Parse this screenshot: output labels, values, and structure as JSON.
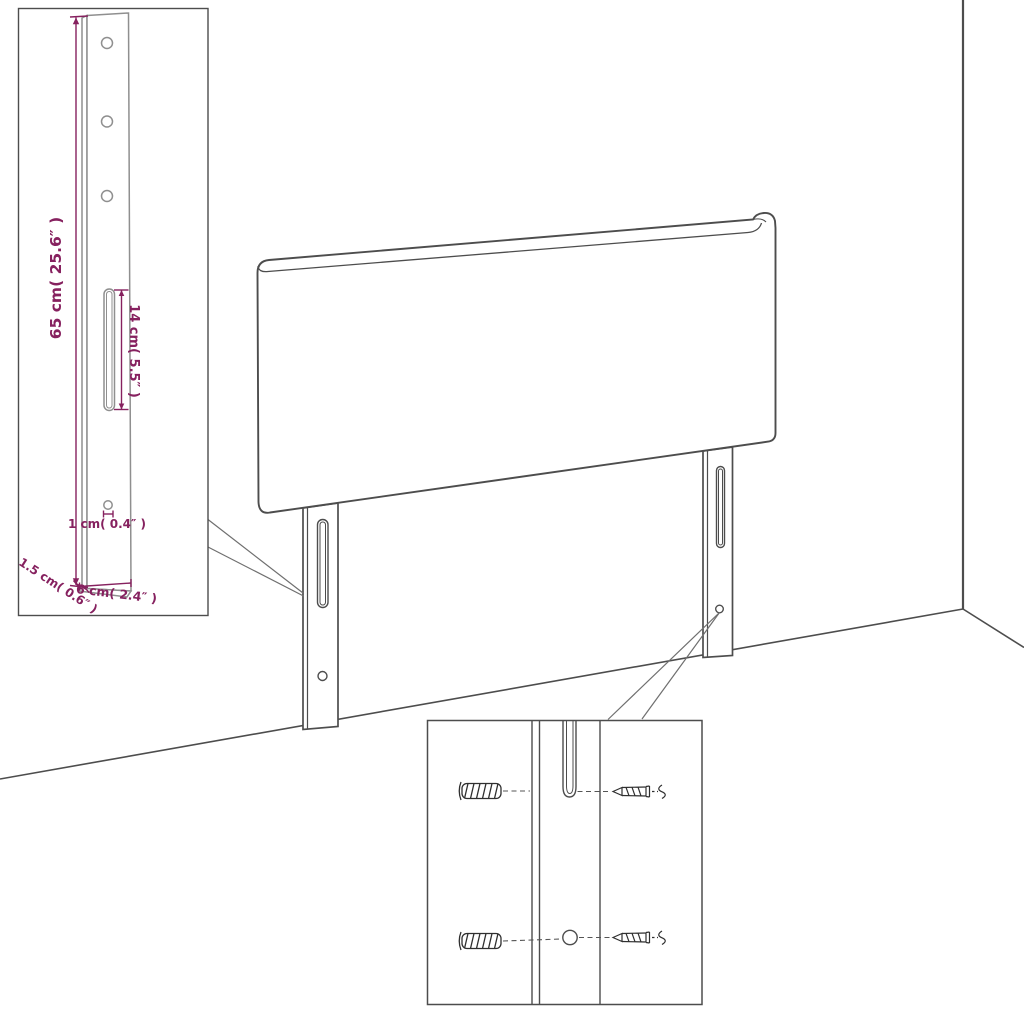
{
  "page": {
    "background": "#ffffff",
    "kind": "furniture dimension diagram",
    "subject": "upholstered headboard with two mounting legs standing against a wall corner"
  },
  "colors": {
    "outline": "#4d4d4d",
    "inset_leg_outline": "#8f8f8f",
    "hardware": "#2f2f2f",
    "dimension": "#86215f"
  },
  "leg_detail_inset": {
    "labels": {
      "height": "65 cm( 25.6″ )",
      "slot_length": "14 cm( 5.5″ )",
      "hole_diameter": "1 cm( 0.4″ )",
      "thickness": "1.5 cm( 0.6″ )",
      "width": "6 cm( 2.4″ )"
    }
  },
  "mounting_inset": {
    "icons": [
      "wall-plug-icon",
      "screw-icon"
    ]
  }
}
